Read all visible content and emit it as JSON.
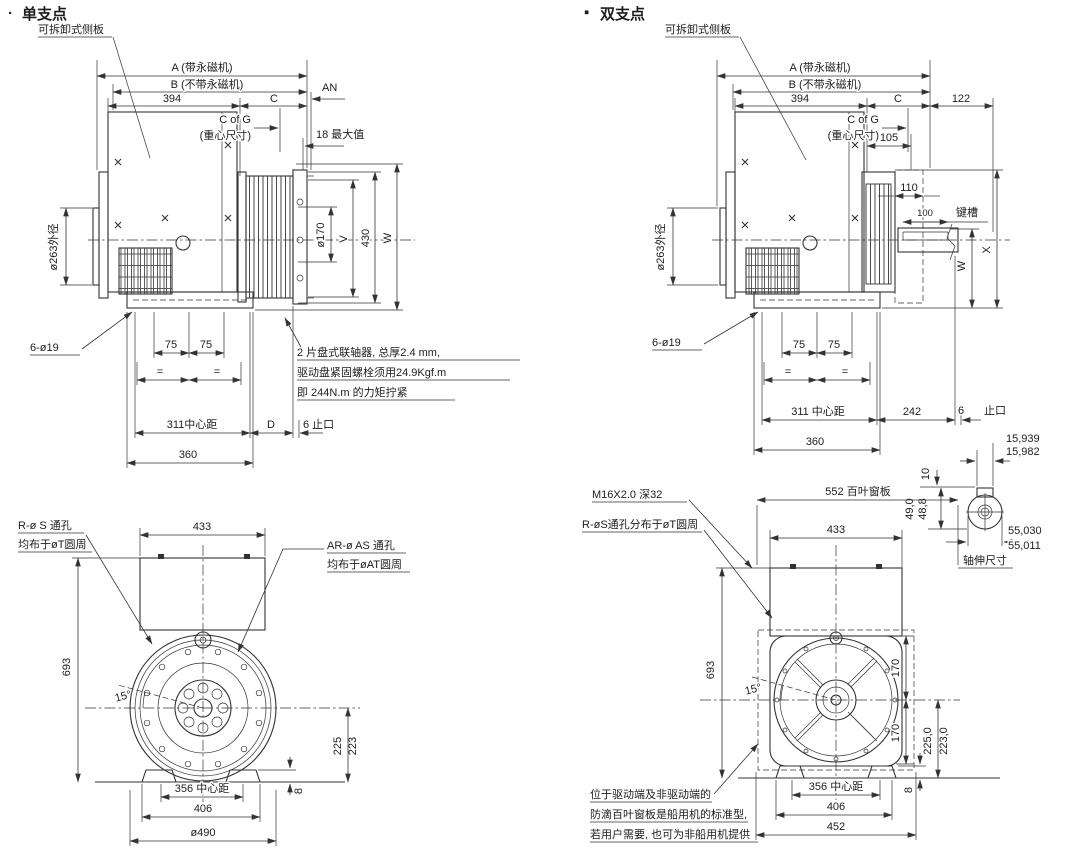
{
  "left": {
    "bullet": "·",
    "title": "单支点",
    "side_plate": "可拆卸式侧板",
    "dims": {
      "a": "A (带永磁机)",
      "b": "B (不带永磁机)",
      "len394": "394",
      "c": "C",
      "an": "AN",
      "cog": "C of G",
      "cog_sub": "(重心尺寸)",
      "max18": "18 最大值",
      "od263": "ø263外径",
      "od170": "ø170",
      "v": "V",
      "h430": "430",
      "w": "W",
      "holes": "6-ø19",
      "p75a": "75",
      "p75b": "75",
      "eq1": "=",
      "eq2": "=",
      "cc311": "311中心距",
      "d": "D",
      "spigot": "6 止口",
      "len360": "360"
    },
    "coupling_note": [
      "2 片盘式联轴器, 总厚2.4 mm,",
      "驱动盘紧固螺栓须用24.9Kgf.m",
      "即 244N.m 的力矩拧紧"
    ],
    "front": {
      "holes_r": "R-ø S 通孔",
      "holes_r_sub": "均布于øT圆周",
      "holes_ar": "AR-ø AS 通孔",
      "holes_ar_sub": "均布于øAT圆周",
      "w433": "433",
      "h693": "693",
      "ang15": "15°",
      "h225": "225",
      "h223": "223",
      "t8": "8",
      "cc356": "356 中心距",
      "w406": "406",
      "od490": "ø490"
    }
  },
  "right": {
    "bullet": "▪",
    "title": "双支点",
    "side_plate": "可拆卸式侧板",
    "dims": {
      "a": "A (带永磁机)",
      "b": "B (不带永磁机)",
      "len394": "394",
      "c": "C",
      "len122": "122",
      "cog": "C of G",
      "cog_sub": "(重心尺寸)",
      "len105": "105",
      "len110": "110",
      "len100": "100",
      "keyway": "键槽",
      "od263": "ø263外径",
      "w": "W",
      "x": "X",
      "holes": "6-ø19",
      "p75a": "75",
      "p75b": "75",
      "eq1": "=",
      "eq2": "=",
      "cc311": "311 中心距",
      "len242": "242",
      "spigot6": "6",
      "spigot": "止口",
      "len360": "360"
    },
    "shaft": {
      "k1": "15,939",
      "k2": "15,982",
      "k10": "10",
      "h1": "49,0",
      "h2": "48,8",
      "d1": "55,030",
      "d2": "55,011",
      "label": "轴伸尺寸"
    },
    "front": {
      "m16": "M16X2.0 深32",
      "holes_r": "R-øS通孔分布于øT圆周",
      "louver552": "552 百叶窗板",
      "w433": "433",
      "h693": "693",
      "ang15": "15°",
      "v170a": "170",
      "v170b": "170",
      "h2250": "225,0",
      "h2230": "223,0",
      "t8": "8",
      "cc356": "356 中心距",
      "w406": "406",
      "w452": "452"
    },
    "louver_note": [
      "位于驱动端及非驱动端的",
      "防滴百叶窗板是船用机的标准型,",
      "若用户需要, 也可为非船用机提供"
    ]
  }
}
